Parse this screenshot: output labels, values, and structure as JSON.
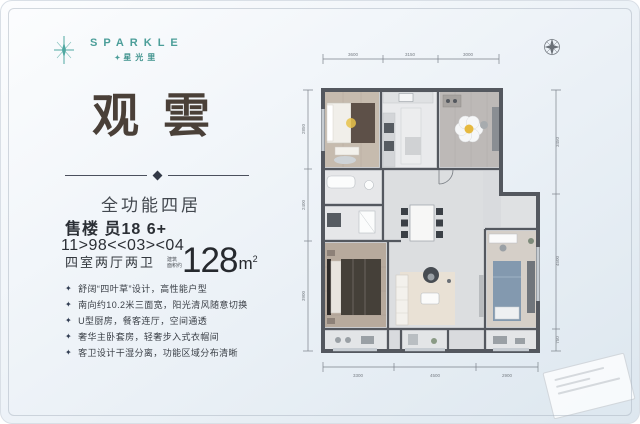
{
  "ui": {
    "bullet_icon": "✦",
    "brand_mark": "✦"
  },
  "brand": {
    "name": "SPARKLE",
    "sub": "星光里"
  },
  "page": {
    "title": "观雲"
  },
  "specs": {
    "layout": "全功能四居",
    "line1": "售楼 员18 6+",
    "line2": "11>98<<03><04",
    "rooms": "四室两厅两卫",
    "area_label_1": "建筑",
    "area_label_2": "面积约",
    "area_number": "128",
    "area_unit": "m",
    "area_exp": "2"
  },
  "highlights": [
    "舒阔“四叶草”设计，高性能户型",
    "南向约10.2米三面宽，阳光清风随意切换",
    "U型厨房，餐客连厅，空间通透",
    "奢华主卧套房，轻奢步入式衣帽间",
    "客卫设计干湿分离，功能区域分布清晰"
  ],
  "floorplan": {
    "dims_top": [
      "3600",
      "3150",
      "3000"
    ],
    "dims_bottom": [
      "3300",
      "4500",
      "2900"
    ],
    "dims_left": [
      "2850",
      "2400",
      "3900"
    ],
    "dims_right": [
      "3450",
      "4500",
      "750"
    ]
  }
}
